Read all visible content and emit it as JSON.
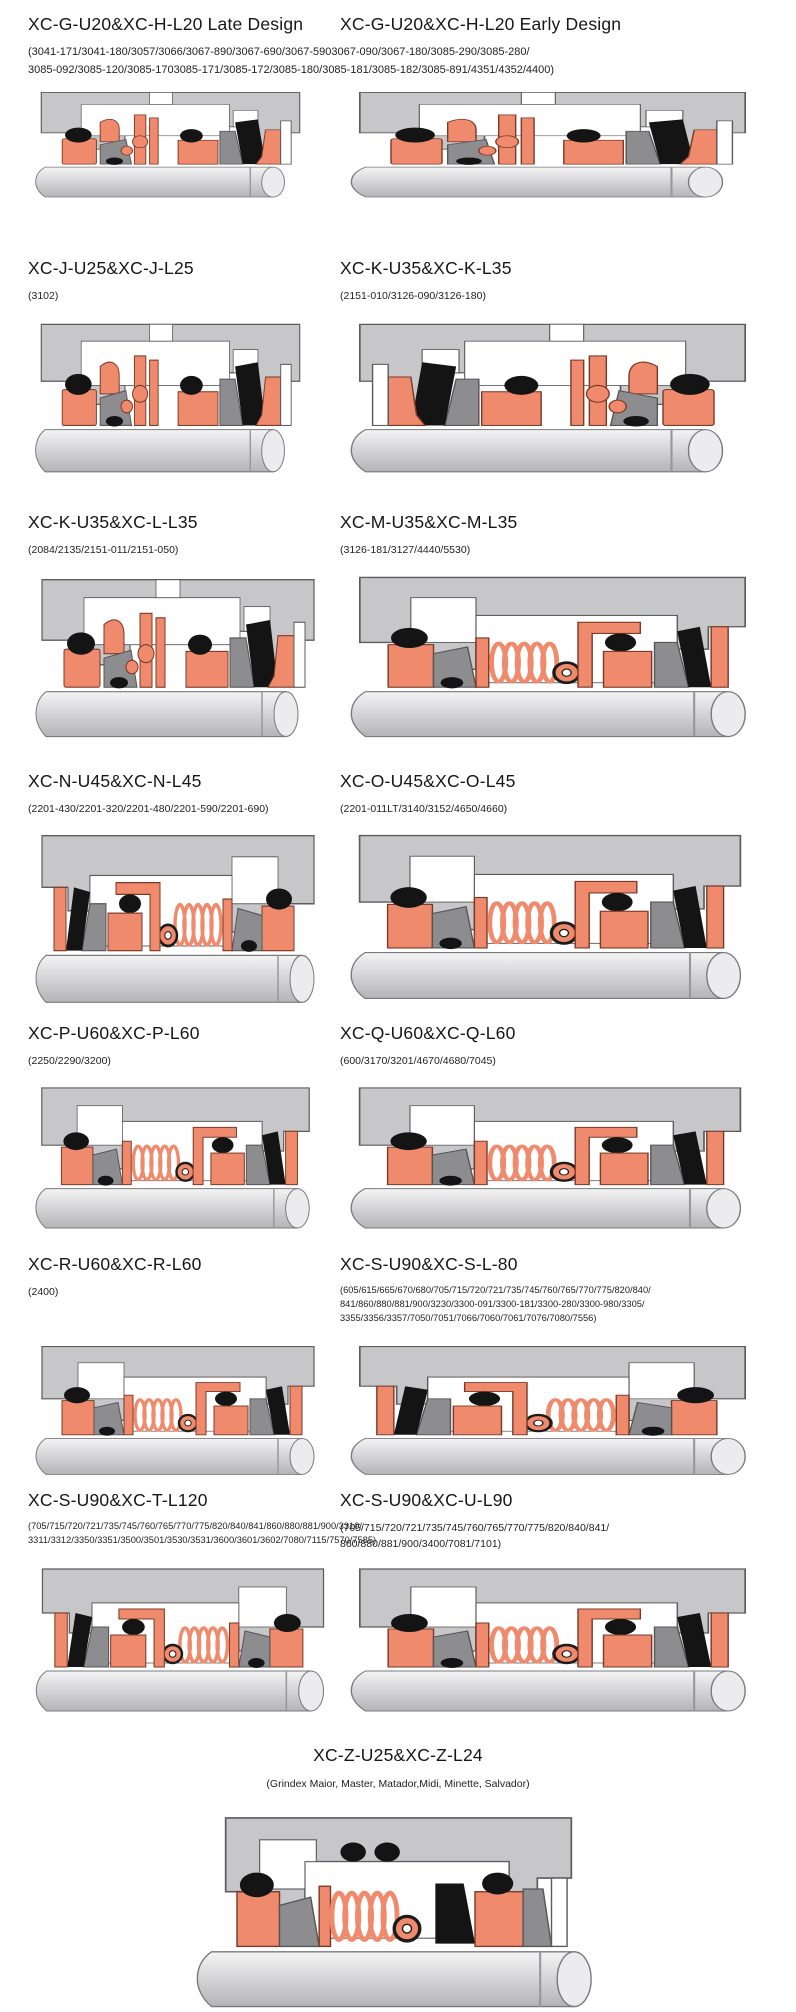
{
  "colors": {
    "seal_salmon": "#ef8a6d",
    "seal_outline": "#7a3a28",
    "housing_gray": "#c7c7c9",
    "housing_outline": "#5c5c5e",
    "metal_dark_gray": "#8d8d8f",
    "elastomer_black": "#141414",
    "shaft_light": "#ececee"
  },
  "icons": {
    "diagram": "seal-cross-section-diagram"
  },
  "sections": [
    {
      "cells": [
        {
          "title": "XC-G-U20&XC-H-L20 Late Design"
        },
        {
          "title": "XC-G-U20&XC-H-L20 Early Design"
        }
      ],
      "shared_subtitle": [
        "(3041-171/3041-180/3057/3066/3067-890/3067-690/3067-5903067-090/3067-180/3085-290/3085-280/",
        "3085-092/3085-120/3085-1703085-171/3085-172/3085-180/3085-181/3085-182/3085-891/4351/4352/4400)"
      ]
    },
    {
      "cells": [
        {
          "title": "XC-J-U25&XC-J-L25",
          "subtitle": [
            "(3102)"
          ]
        },
        {
          "title": "XC-K-U35&XC-K-L35",
          "subtitle": [
            "(2151-010/3126-090/3126-180)"
          ]
        }
      ]
    },
    {
      "cells": [
        {
          "title": "XC-K-U35&XC-L-L35",
          "subtitle": [
            "(2084/2135/2151-011/2151-050)"
          ]
        },
        {
          "title": "XC-M-U35&XC-M-L35",
          "subtitle": [
            "(3126-181/3127/4440/5530)"
          ]
        }
      ]
    },
    {
      "cells": [
        {
          "title": "XC-N-U45&XC-N-L45",
          "subtitle": [
            "(2201-430/2201-320/2201-480/2201-590/2201-690)"
          ]
        },
        {
          "title": "XC-O-U45&XC-O-L45",
          "subtitle": [
            "(2201-011LT/3140/3152/4650/4660)"
          ]
        }
      ]
    },
    {
      "cells": [
        {
          "title": "XC-P-U60&XC-P-L60",
          "subtitle": [
            "(2250/2290/3200)"
          ]
        },
        {
          "title": "XC-Q-U60&XC-Q-L60",
          "subtitle": [
            "(600/3170/3201/4670/4680/7045)"
          ]
        }
      ]
    },
    {
      "cells": [
        {
          "title": "XC-R-U60&XC-R-L60",
          "subtitle": [
            "(2400)"
          ]
        },
        {
          "title": "XC-S-U90&XC-S-L-80",
          "subtitle": [
            "(605/615/665/670/680/705/715/720/721/735/745/760/765/770/775/820/840/",
            "841/860/880/881/900/3230/3300-091/3300-181/3300-280/3300-980/3305/",
            "3355/3356/3357/7050/7051/7066/7060/7061/7076/7080/7556)"
          ]
        }
      ]
    },
    {
      "cells": [
        {
          "title": "XC-S-U90&XC-T-L120",
          "subtitle": [
            "(705/715/720/721/735/745/760/765/770/775/820/840/841/860/880/881/900/3310/",
            "3311/3312/3350/3351/3500/3501/3530/3531/3600/3601/3602/7080/7115/7570/7585)"
          ]
        },
        {
          "title": "XC-S-U90&XC-U-L90",
          "subtitle": [
            "(705/715/720/721/735/745/760/765/770/775/820/840/841/",
            "860/880/881/900/3400/7081/7101)"
          ]
        }
      ]
    },
    {
      "centered": true,
      "cells": [
        {
          "title": "XC-Z-U25&XC-Z-L24",
          "subtitle": [
            "(Grindex  Maior, Master, Matador,Midi, Minette, Salvador)"
          ]
        }
      ]
    }
  ]
}
